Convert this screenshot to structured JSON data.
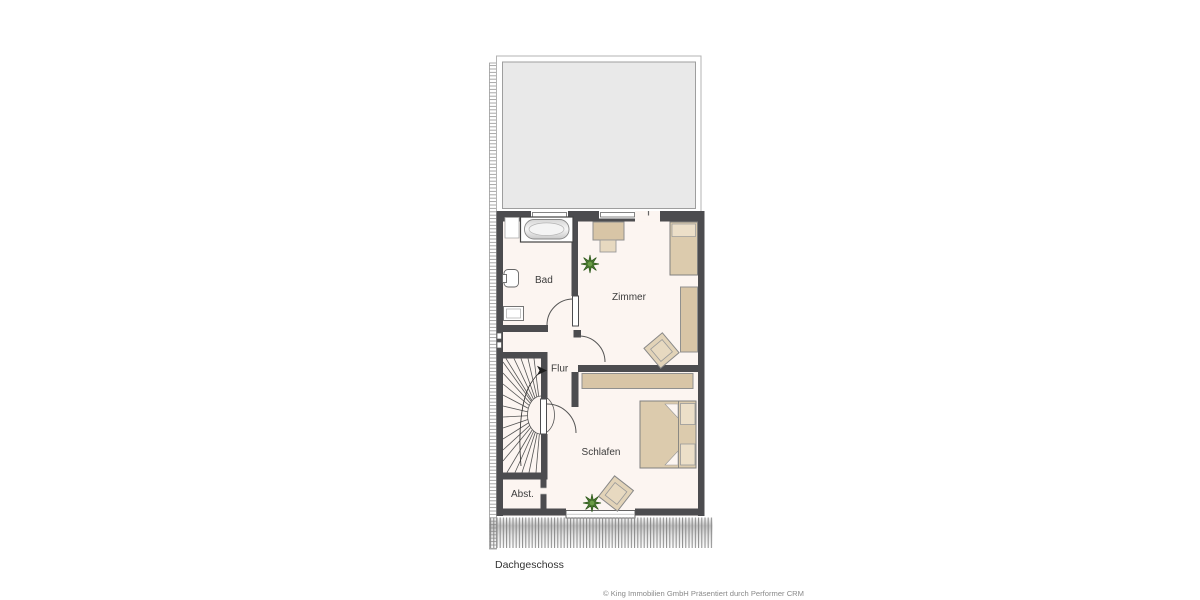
{
  "floor_plan": {
    "floor_label": "Dachgeschoss",
    "credit": "© King Immobilien GmbH Präsentiert durch Performer CRM",
    "rooms": [
      {
        "id": "bad",
        "label": "Bad"
      },
      {
        "id": "zimmer",
        "label": "Zimmer"
      },
      {
        "id": "flur",
        "label": "Flur"
      },
      {
        "id": "schlafen",
        "label": "Schlafen"
      },
      {
        "id": "abstellraum",
        "label": "Abst."
      }
    ],
    "features": [
      "roof-terrace",
      "staircase",
      "bathtub",
      "wc",
      "sink",
      "single-bed",
      "desk",
      "double-bed",
      "wardrobe",
      "armchairs",
      "plants"
    ],
    "colors": {
      "wall": "#4c4c4f",
      "room_fill": "#fcf5f1",
      "terrace_fill": "#e9e9e9",
      "furniture_tan": "#d8c5a6",
      "furniture_light": "#e7d9c0",
      "plant_green": "#4a7a2e",
      "hatch_gray": "#8a8a8a",
      "label_text": "#3c3c3c",
      "credit_text": "#8a8a8a"
    }
  }
}
